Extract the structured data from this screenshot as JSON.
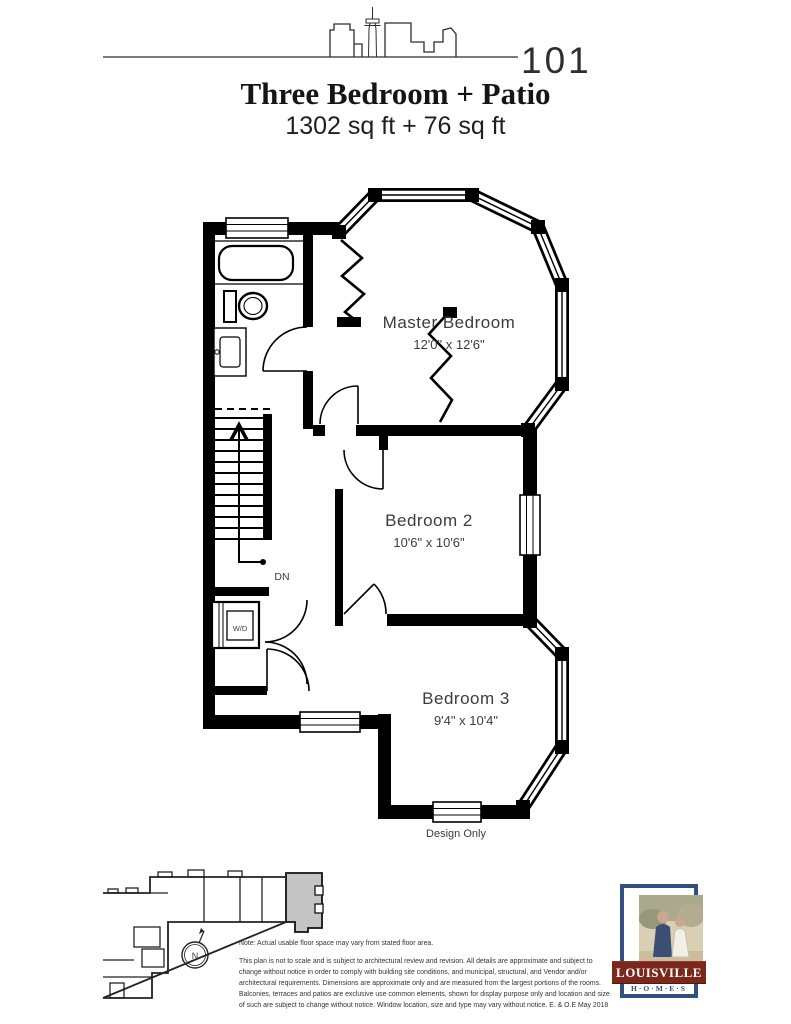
{
  "header": {
    "unit_number": "101",
    "title": "Three Bedroom + Patio",
    "area": "1302 sq ft + 76 sq ft"
  },
  "plan": {
    "rooms": [
      {
        "name": "Master Bedroom",
        "dims": "12'0\" x 12'6\""
      },
      {
        "name": "Bedroom 2",
        "dims": "10'6\" x 10'6\""
      },
      {
        "name": "Bedroom 3",
        "dims": "9'4\" x 10'4\""
      }
    ],
    "labels": {
      "down": "DN",
      "washer_dryer": "W/D",
      "design_only": "Design Only"
    }
  },
  "keyplan": {
    "north_label": "N",
    "highlight_color": "#c4c4c4"
  },
  "notes": {
    "note": "Note: Actual usable floor space may vary from stated floor area.",
    "disclaimer": "This plan is not to scale and is subject to architectural review and revision. All details are approximate and subject to change without notice in order to comply with building site conditions, and municipal, structural, and Vendor and/or architectural requirements. Dimensions are approximate only and are measured from the largest portions of the rooms. Balconies, terraces and patios are exclusive use common elements, shown for display purpose only and location and size of such are subject to change without notice. Window location, size and type may vary without notice. E. & O.E May 2018"
  },
  "logo": {
    "brand": "LOUISVILLE",
    "homes": "H·O·M·E·S",
    "colors": {
      "navy": "#31507f",
      "red": "#7b281c"
    }
  }
}
